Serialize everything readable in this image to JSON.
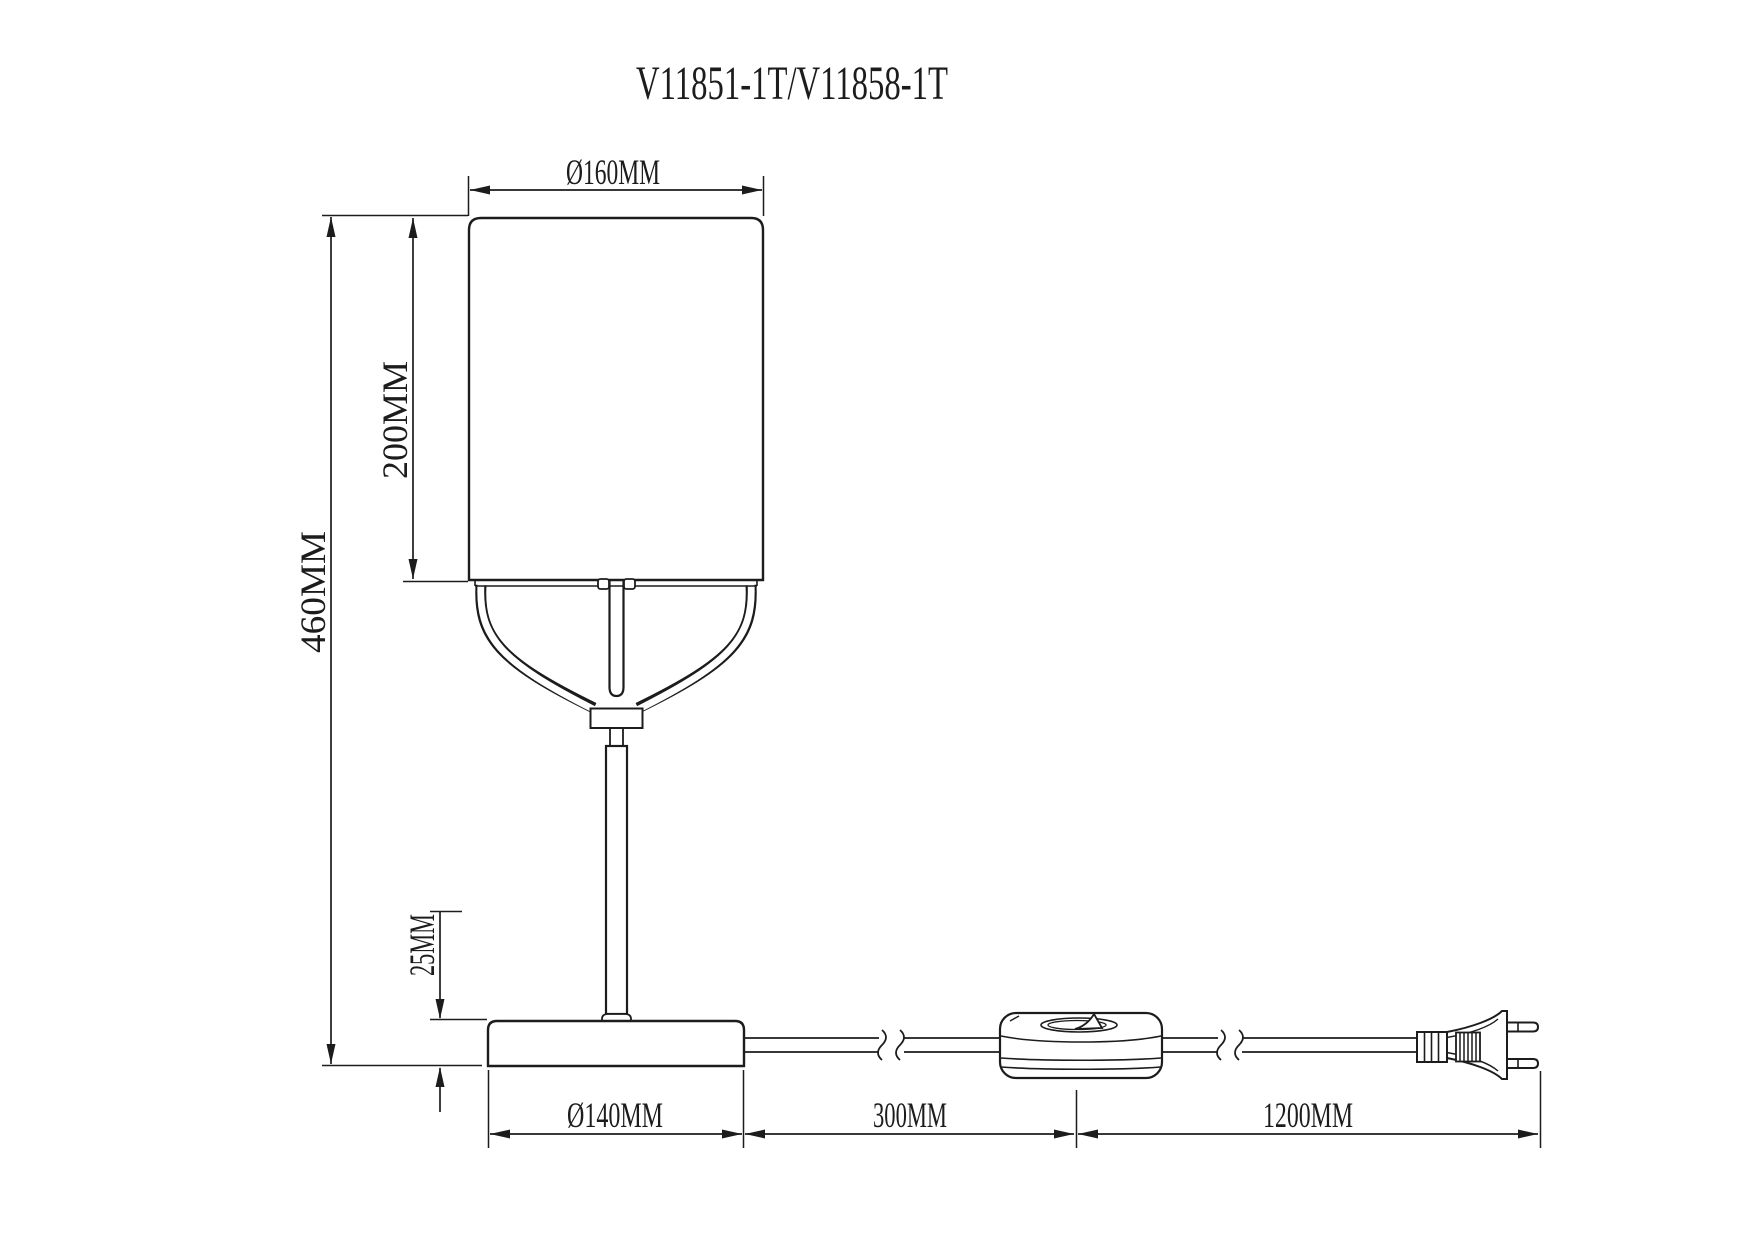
{
  "title": "V11851-1T/V11858-1T",
  "drawing": {
    "type": "technical dimension drawing",
    "subject": "table lamp side elevation with power cord, inline switch and two-pin plug",
    "units": "MM"
  },
  "dimensions": {
    "shade_diameter": {
      "label": "Ø160MM",
      "value": 160
    },
    "shade_height": {
      "label": "200MM",
      "value": 200
    },
    "total_height": {
      "label": "460MM",
      "value": 460
    },
    "base_height": {
      "label": "25MM",
      "value": 25
    },
    "base_diameter": {
      "label": "Ø140MM",
      "value": 140
    },
    "base_to_switch": {
      "label": "300MM",
      "value": 300
    },
    "switch_to_plug": {
      "label": "1200MM",
      "value": 1200
    }
  },
  "parts": [
    "lamp-shade",
    "center-rod",
    "support-fork",
    "stem",
    "base",
    "power-cord",
    "inline-switch",
    "euro-plug"
  ],
  "colors": {
    "line": "#1c1c1c",
    "background": "#ffffff"
  }
}
